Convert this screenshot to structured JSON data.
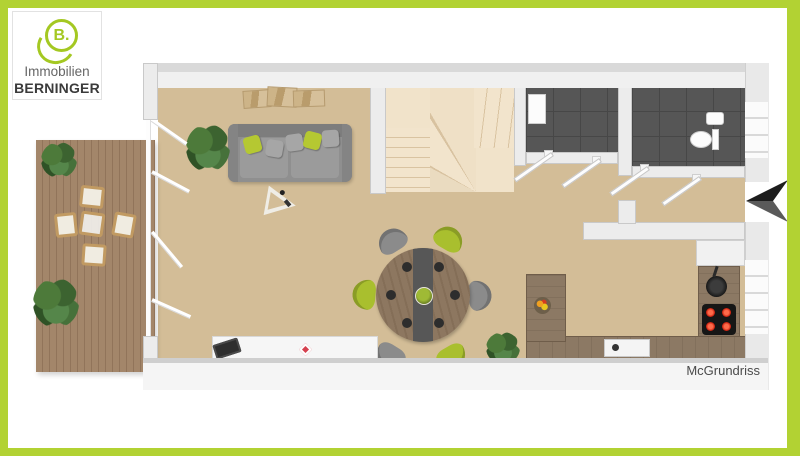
{
  "branding": {
    "logo_letter": "B.",
    "company_line1": "Immobilien",
    "company_line2": "BERNINGER",
    "logo_color": "#a4c822",
    "line1_color": "#666666",
    "line2_color": "#3b3b3b"
  },
  "watermark": {
    "label": "McGrundriss",
    "color": "#4a4a4a"
  },
  "frame": {
    "border_color": "#b2d233",
    "background": "#ffffff"
  },
  "palette": {
    "floor_carpet": "#d3bd97",
    "terrace_wood": "#a3866a",
    "wall": "#ececec",
    "wall_edge": "#c9c9c9",
    "bath_tile": "#565656",
    "stairs": "#f1e3ca",
    "sofa_gray": "#8f8f8f",
    "accent_green": "#b5c832",
    "table_wood": "#8d7760",
    "counter_wood": "#8c7964",
    "burner_red": "#e02f1f",
    "arrow_black": "#1d1d1d"
  },
  "scene": {
    "objects": [
      "terrace-deck",
      "outdoor-dining-set",
      "potted-plants",
      "sofa",
      "wall-art",
      "lounge-chair",
      "round-dining-table",
      "dining-chairs",
      "winder-staircase",
      "shower-bath",
      "wc-toilet",
      "hall-doors",
      "kitchen-counter",
      "cooktop",
      "pan",
      "sink",
      "fruit-bowl",
      "sideboard",
      "laptop",
      "entrance-arrow"
    ]
  }
}
